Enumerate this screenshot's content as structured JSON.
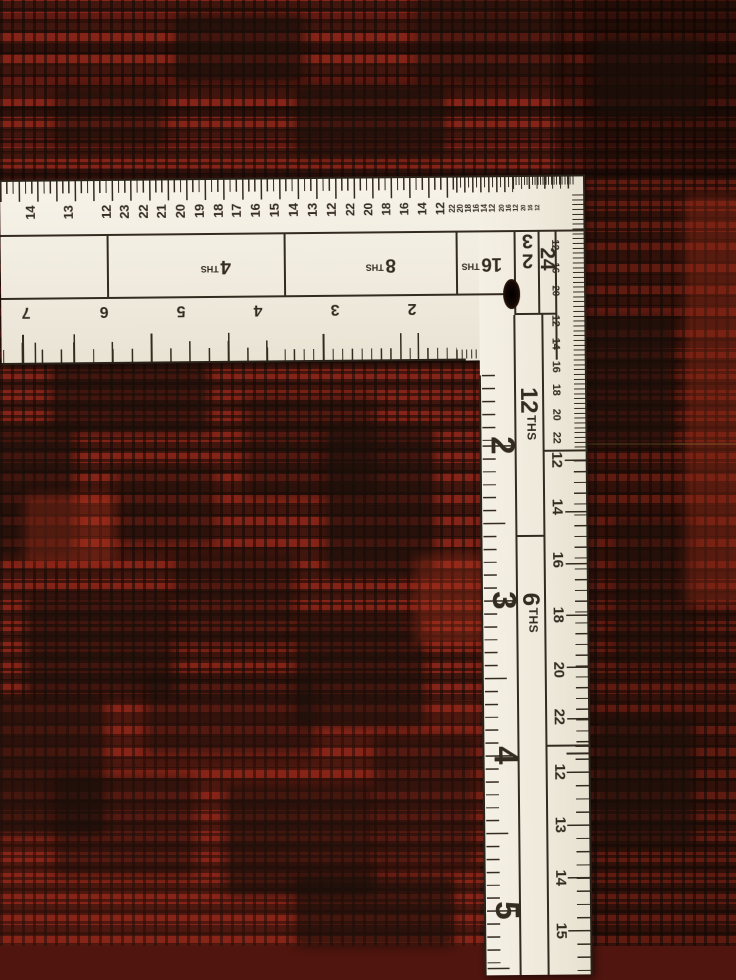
{
  "colors": {
    "ruler_face": "#f1ecdf",
    "ruler_ink": "#332a20",
    "carpet_red": "#6b2015",
    "carpet_dark": "#241410",
    "carpet_bright": "#9e3322"
  },
  "square": {
    "blade": {
      "top_numbers": [
        {
          "v": "14",
          "x": 30,
          "s": 13
        },
        {
          "v": "13",
          "x": 68,
          "s": 13
        },
        {
          "v": "12",
          "x": 106,
          "s": 13
        },
        {
          "v": "23",
          "x": 124,
          "s": 13
        },
        {
          "v": "22",
          "x": 143,
          "s": 13
        },
        {
          "v": "21",
          "x": 161,
          "s": 13
        },
        {
          "v": "20",
          "x": 180,
          "s": 13
        },
        {
          "v": "19",
          "x": 199,
          "s": 13
        },
        {
          "v": "18",
          "x": 218,
          "s": 13
        },
        {
          "v": "17",
          "x": 236,
          "s": 13
        },
        {
          "v": "16",
          "x": 255,
          "s": 13
        },
        {
          "v": "15",
          "x": 274,
          "s": 13
        },
        {
          "v": "14",
          "x": 293,
          "s": 13
        },
        {
          "v": "13",
          "x": 312,
          "s": 13
        },
        {
          "v": "12",
          "x": 331,
          "s": 13
        },
        {
          "v": "22",
          "x": 350,
          "s": 12
        },
        {
          "v": "20",
          "x": 368,
          "s": 12
        },
        {
          "v": "18",
          "x": 386,
          "s": 12
        },
        {
          "v": "16",
          "x": 404,
          "s": 12
        },
        {
          "v": "14",
          "x": 422,
          "s": 12
        },
        {
          "v": "12",
          "x": 440,
          "s": 12
        },
        {
          "v": "22",
          "x": 452,
          "s": 8
        },
        {
          "v": "20",
          "x": 460,
          "s": 8
        },
        {
          "v": "18",
          "x": 468,
          "s": 8
        },
        {
          "v": "16",
          "x": 476,
          "s": 8
        },
        {
          "v": "14",
          "x": 484,
          "s": 8
        },
        {
          "v": "12",
          "x": 492,
          "s": 8
        },
        {
          "v": "20",
          "x": 502,
          "s": 7
        },
        {
          "v": "16",
          "x": 509,
          "s": 7
        },
        {
          "v": "12",
          "x": 516,
          "s": 7
        },
        {
          "v": "20",
          "x": 524,
          "s": 6
        },
        {
          "v": "16",
          "x": 531,
          "s": 6
        },
        {
          "v": "12",
          "x": 538,
          "s": 6
        }
      ],
      "bottom_numbers": [
        {
          "v": "7",
          "x": 25
        },
        {
          "v": "6",
          "x": 103
        },
        {
          "v": "5",
          "x": 180
        },
        {
          "v": "4",
          "x": 257
        },
        {
          "v": "3",
          "x": 334
        },
        {
          "v": "2",
          "x": 411
        }
      ],
      "fraction_labels": [
        {
          "num": "4",
          "suffix": "THS",
          "x": 215
        },
        {
          "num": "8",
          "suffix": "THS",
          "x": 380
        },
        {
          "num": "16",
          "suffix": "THS",
          "x": 481
        }
      ]
    },
    "corner": {
      "label_32_top_digit": "3",
      "label_32_bottom_digit": "2",
      "label_24": "24"
    },
    "tongue": {
      "big_numbers": [
        {
          "v": "2",
          "y": 270
        },
        {
          "v": "3",
          "y": 425
        },
        {
          "v": "4",
          "y": 580
        },
        {
          "v": "5",
          "y": 735
        }
      ],
      "section_labels": [
        {
          "num": "12",
          "suffix": "THS",
          "y": 239
        },
        {
          "num": "6",
          "suffix": "THS",
          "y": 438
        }
      ],
      "edge_numbers": [
        {
          "v": "12",
          "y": 70,
          "s": 10
        },
        {
          "v": "16",
          "y": 93,
          "s": 10
        },
        {
          "v": "20",
          "y": 116,
          "s": 10
        },
        {
          "v": "12",
          "y": 146,
          "s": 11
        },
        {
          "v": "14",
          "y": 169,
          "s": 11
        },
        {
          "v": "16",
          "y": 192,
          "s": 11
        },
        {
          "v": "18",
          "y": 215,
          "s": 11
        },
        {
          "v": "20",
          "y": 240,
          "s": 11
        },
        {
          "v": "22",
          "y": 263,
          "s": 11
        },
        {
          "v": "12",
          "y": 285,
          "s": 15
        },
        {
          "v": "14",
          "y": 332,
          "s": 15
        },
        {
          "v": "16",
          "y": 385,
          "s": 15
        },
        {
          "v": "18",
          "y": 440,
          "s": 15
        },
        {
          "v": "20",
          "y": 495,
          "s": 15
        },
        {
          "v": "22",
          "y": 542,
          "s": 15
        },
        {
          "v": "12",
          "y": 597,
          "s": 15
        },
        {
          "v": "13",
          "y": 650,
          "s": 15
        },
        {
          "v": "14",
          "y": 703,
          "s": 15
        },
        {
          "v": "15",
          "y": 756,
          "s": 15
        }
      ]
    }
  }
}
